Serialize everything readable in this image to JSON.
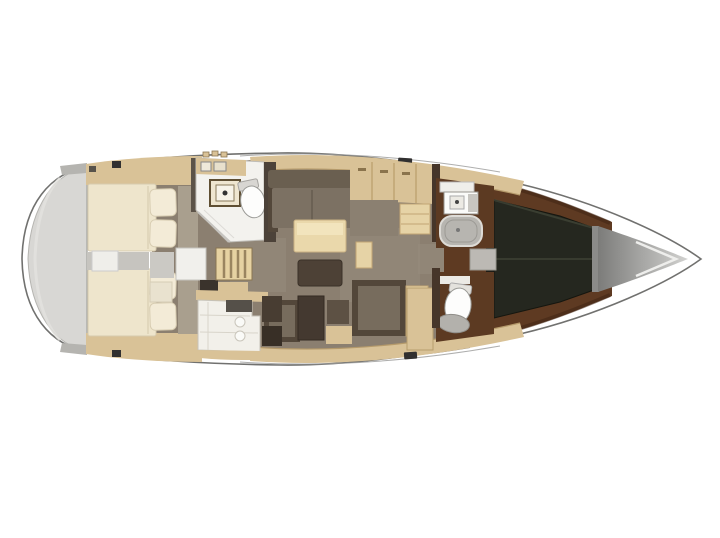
{
  "meta": {
    "type": "boat-floorplan",
    "description": "Top-view interior layout plan of a sailing yacht, bow pointing right"
  },
  "colors": {
    "hull_outline": "#71716f",
    "deck_white": "#ffffff",
    "stern_platform": "#d8d7d4",
    "wood_light": "#d9c297",
    "mattress_cream": "#eee5cc",
    "floor_taupe": "#8b7f70",
    "sofa_taupe": "#7c7163",
    "sofa_frame": "#53473a",
    "table_cream": "#ead8ab",
    "ottoman_brown": "#4d4136",
    "bath_white": "#f3f2ee",
    "shower_gray": "#b7b5b0",
    "fwd_floor_brown": "#5e3a22",
    "vberth_dark": "#25271f",
    "anchor_gray_dark": "#7c7c7a",
    "anchor_gray_light": "#d2d2d0"
  },
  "regions": [
    {
      "id": "stern-swim-platform",
      "label": "stern swim platform"
    },
    {
      "id": "aft-cabin-top",
      "label": "aft double cabin with berth and pillows (top)"
    },
    {
      "id": "aft-cabin-bottom",
      "label": "aft double cabin with berth and pillows (bottom)"
    },
    {
      "id": "engine-compartment",
      "label": "engine compartment between aft cabins"
    },
    {
      "id": "companionway-steps",
      "label": "companionway steps"
    },
    {
      "id": "aft-head",
      "label": "aft bathroom with sink and toilet"
    },
    {
      "id": "saloon",
      "label": "saloon with sofa, table and ottoman"
    },
    {
      "id": "galley",
      "label": "galley counter"
    },
    {
      "id": "nav-station",
      "label": "chart table and navigation seat"
    },
    {
      "id": "sideboard",
      "label": "sideboard cabinet with drawers"
    },
    {
      "id": "forward-head-shower",
      "label": "forward bathroom with sink and shower"
    },
    {
      "id": "forward-head-toilet",
      "label": "forward bathroom with toilet"
    },
    {
      "id": "forward-cabin",
      "label": "forward owner cabin with V-berth"
    },
    {
      "id": "anchor-locker",
      "label": "anchor locker"
    },
    {
      "id": "bow",
      "label": "bow tip"
    }
  ]
}
